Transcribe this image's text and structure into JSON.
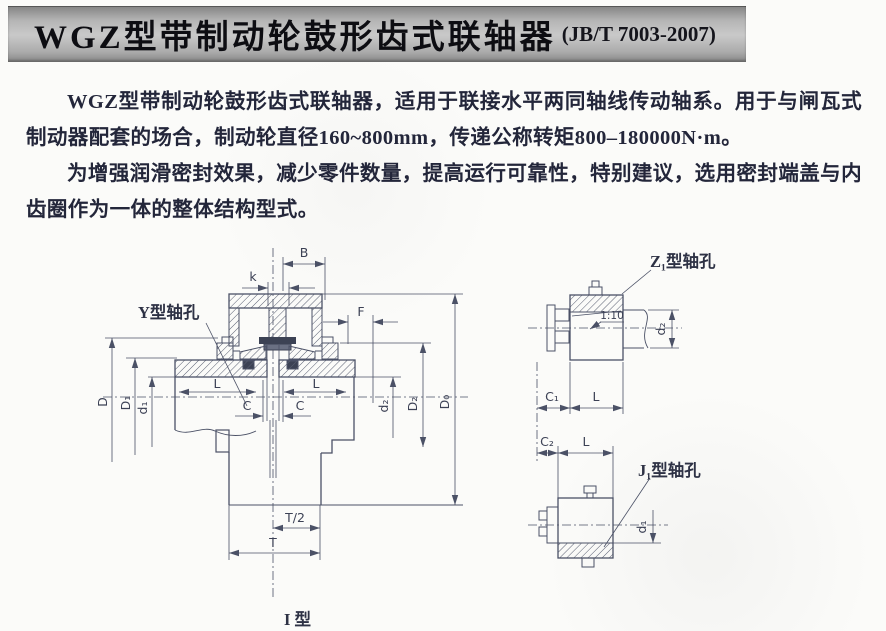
{
  "header": {
    "title": "WGZ型带制动轮鼓形齿式联轴器",
    "standard_ref": "(JB/T 7003-2007)"
  },
  "body_text": {
    "paragraph1": "WGZ型带制动轮鼓形齿式联轴器，适用于联接水平两同轴线传动轴系。用于与闸瓦式制动器配套的场合，制动轮直径160~800mm，传递公称转矩800–180000N·m。",
    "paragraph2": "为增强润滑密封效果，减少零件数量，提高运行可靠性，特别建议，选用密封端盖与内齿圈作为一体的整体结构型式。"
  },
  "diagram": {
    "caption": "I 型",
    "main_view": {
      "callout_y_hole": "Y型轴孔",
      "dims": {
        "B": "B",
        "k": "k",
        "F": "F",
        "D": "D",
        "D1": "D₁",
        "d1": "d₁",
        "d2": "d₂",
        "D2": "D₂",
        "D0": "D₀",
        "L": "L",
        "C": "C",
        "T_half": "T/2",
        "T": "T"
      }
    },
    "z1_view": {
      "callout": "Z₁型轴孔",
      "taper": "1:10",
      "dims": {
        "d2": "d₂",
        "C1": "C₁",
        "L": "L"
      }
    },
    "j1_view": {
      "callout": "J₁型轴孔",
      "dims": {
        "d1": "d₁",
        "C2": "C₂",
        "L": "L"
      }
    },
    "colors": {
      "line": "#4b5166",
      "paper": "#fbfbf9",
      "titlebar_gray": "#b5b5b5"
    }
  }
}
